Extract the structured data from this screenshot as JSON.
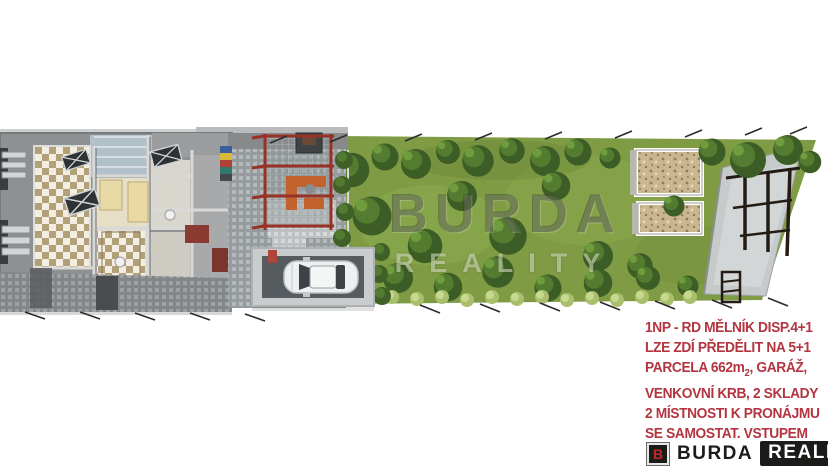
{
  "watermark": {
    "line1": "BURDA",
    "line2": "REALITY"
  },
  "description": {
    "line1": "1NP - RD MĚLNÍK DISP.4+1",
    "line2": "LZE ZDÍ PŘEDĚLIT NA 5+1",
    "line3_prefix": "PARCELA 662m",
    "line3_sub": "2",
    "line3_suffix": ", GARÁŽ,",
    "line4": "VENKOVNÍ KRB, 2 SKLADY",
    "line5": "2 MÍSTNOSTI K PRONÁJMU",
    "line6": "SE SAMOSTAT. VSTUPEM"
  },
  "logo": {
    "monogram": "B",
    "name": "BURDA",
    "suffix": "REALITY"
  },
  "colors": {
    "accent_red": "#b23540",
    "logo_black": "#1b1b19",
    "logo_red": "#c0272d",
    "grass_green": "#7f9b44",
    "pergola_red": "#993226"
  }
}
